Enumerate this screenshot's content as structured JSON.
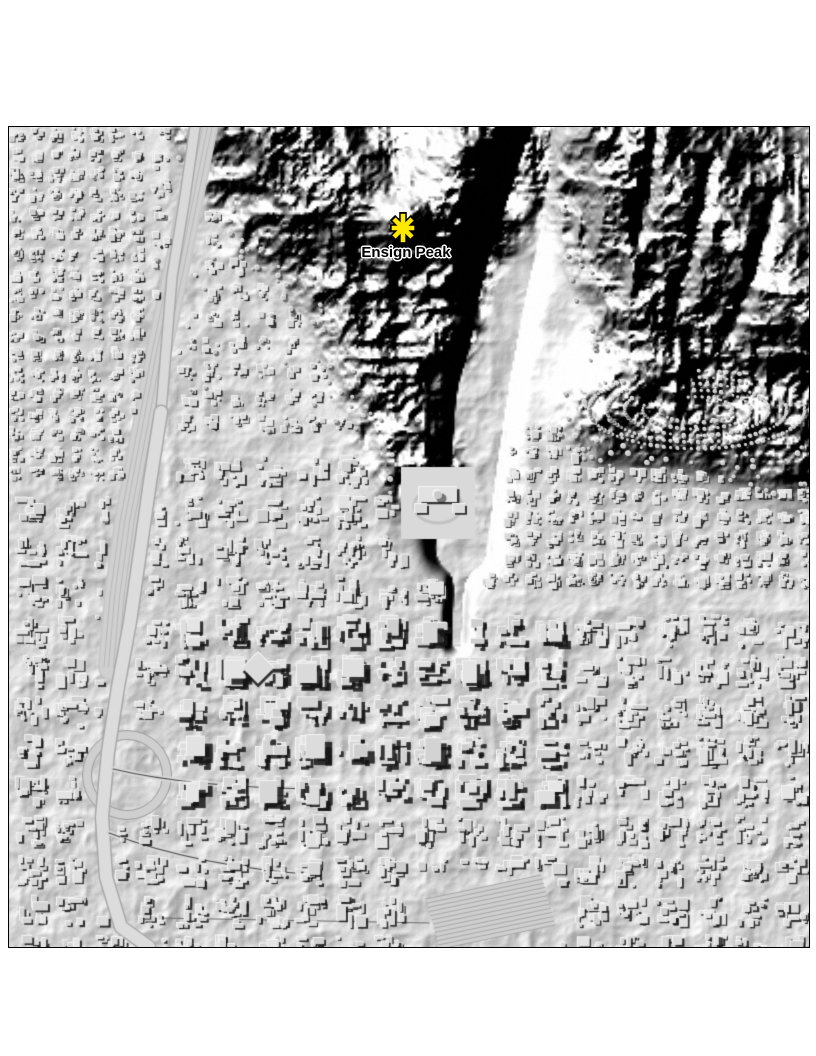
{
  "page": {
    "background_color": "#ffffff"
  },
  "map": {
    "title": "Hillshade relief map of Salt Lake City and Ensign Peak",
    "kind": "lidar-hillshade-raster",
    "frame": {
      "left": 8,
      "top": 126,
      "width": 800,
      "height": 820,
      "border_color": "#000000"
    },
    "colors": {
      "base": "#d2d2d2",
      "terrain_dark": "#1c1c1c",
      "terrain_light": "#ffffff",
      "building_shadow": "#191919",
      "building_highlight": "#f5f5f5",
      "marker_fill": "#ffe900",
      "marker_outline": "#000000",
      "label_color": "#000000",
      "label_halo": "#ffffff"
    },
    "marker": {
      "label": "Ensign Peak",
      "symbol": "asterisk-icon",
      "x": 394,
      "y": 101,
      "size": 36,
      "label_x": 397,
      "label_y": 118,
      "label_font_size": 15
    }
  }
}
